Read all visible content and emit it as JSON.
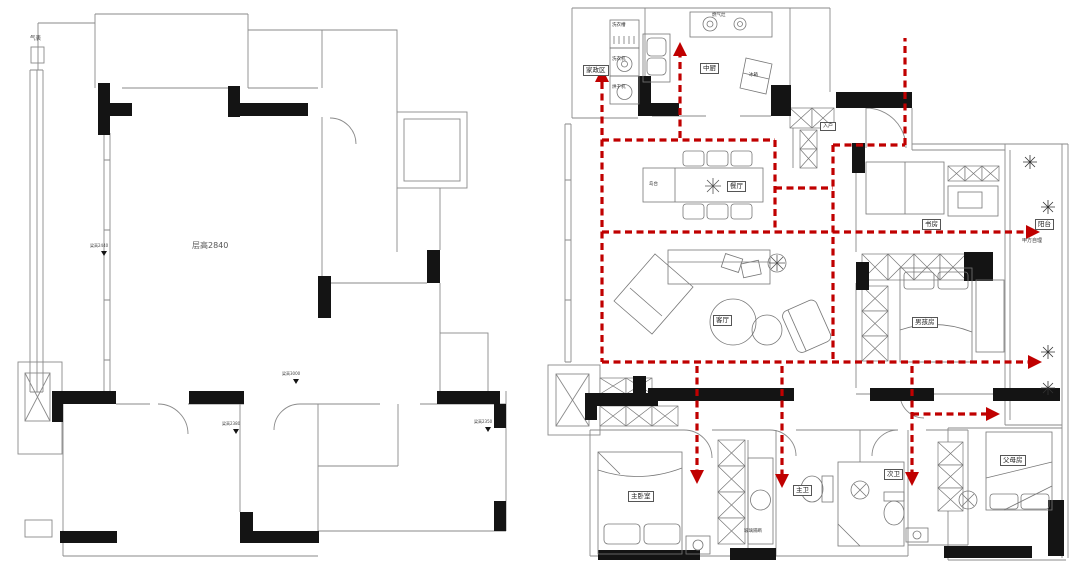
{
  "left_plan": {
    "title_note": "original structural plan",
    "labels": {
      "gas_meter": "气表",
      "ceiling_height": "层高2840",
      "beam_marker_left": "梁高2440",
      "beam_marker_top": "梁高3000",
      "beam_marker_hall_left": "梁高2380",
      "beam_marker_hall_right": "梁高2350"
    }
  },
  "right_plan": {
    "title_note": "furnished layout plan with circulation route",
    "route": {
      "color": "#c00000",
      "style": "dashed"
    },
    "room_labels": {
      "laundry_zone": "家政区",
      "chinese_kitchen": "中厨",
      "dining_room": "餐厅",
      "living_room": "客厅",
      "study": "书房",
      "balcony": "阳台",
      "boy_room": "男孩房",
      "master_bedroom": "主卧室",
      "master_bath": "主卫",
      "second_bath": "次卫",
      "parents_room": "父母房",
      "entry": "入户"
    },
    "item_labels": {
      "laundry_sink": "洗衣槽",
      "washer": "洗衣机",
      "dryer": "烘干机",
      "gas_stove": "燃气灶",
      "fridge": "冰箱",
      "island": "岛台",
      "owner_managed": "甲方自理",
      "glass_partition": "玻璃隔断"
    }
  }
}
